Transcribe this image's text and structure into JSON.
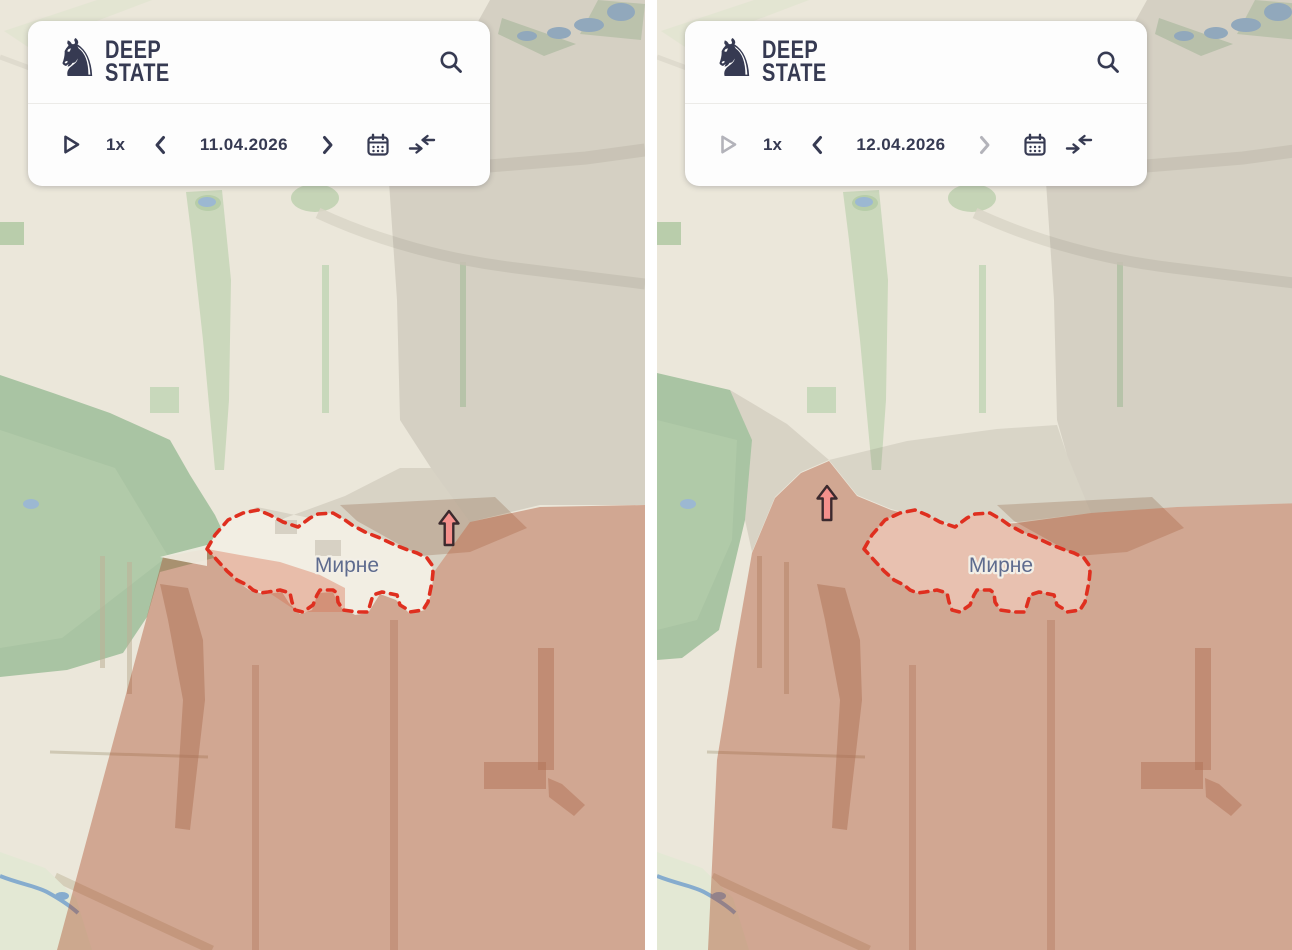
{
  "brand": {
    "line1": "DEEP",
    "line2": "STATE"
  },
  "icons": {
    "knight_glyph": "♞"
  },
  "panels": [
    {
      "date": "11.04.2026",
      "speed": "1x",
      "play_enabled": true,
      "prev_enabled": true,
      "next_enabled": true,
      "map": {
        "settlement_label": "Мирне",
        "advance_arrow": "up"
      }
    },
    {
      "date": "12.04.2026",
      "speed": "1x",
      "play_enabled": false,
      "prev_enabled": true,
      "next_enabled": false,
      "map": {
        "settlement_label": "Мирне",
        "advance_arrow": "up"
      }
    }
  ],
  "colors": {
    "map_base": "#ebe7da",
    "terrain_green": "#a9c4a3",
    "grey_zone": "#d9d3c7",
    "occupied_territory": "#d1a696",
    "frontline_dash_red": "#df2f1f",
    "settlement_label": "#5e6b8e",
    "brand_navy": "#363a52",
    "disabled_gray": "#b3b3ba",
    "advance_arrow_fill": "#f5908c",
    "water": "#9cb8d2"
  }
}
